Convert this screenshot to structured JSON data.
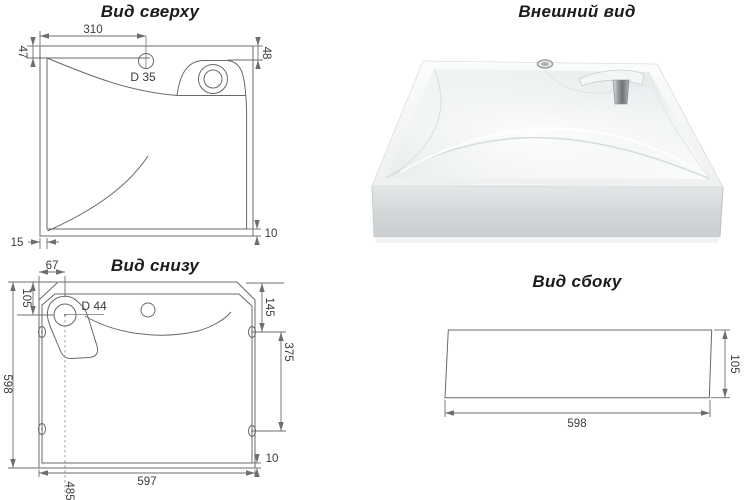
{
  "drawing": {
    "background_color": "#ffffff",
    "line_color": "#686868",
    "text_color": "#3a3a3a",
    "views": {
      "top_view": {
        "title": "Вид сверху",
        "dimensions": {
          "faucet_offset_x": "310",
          "left_rim": "47",
          "right_rim": "48",
          "faucet_diameter": "D 35",
          "bottom_left_rim": "15",
          "bottom_right_rim": "10"
        }
      },
      "external_view": {
        "title": "Внешний вид"
      },
      "bottom_view": {
        "title": "Вид снизу",
        "dimensions": {
          "drain_offset_x": "67",
          "drain_offset_y": "105",
          "drain_diameter": "D 44",
          "overall_depth": "598",
          "hole_offset_top": "145",
          "holes_span": "375",
          "rim_thickness": "10",
          "overall_width": "597",
          "drain_offset_bottom": "485"
        }
      },
      "side_view": {
        "title": "Вид сбоку",
        "dimensions": {
          "width": "598",
          "height": "105"
        }
      }
    }
  }
}
